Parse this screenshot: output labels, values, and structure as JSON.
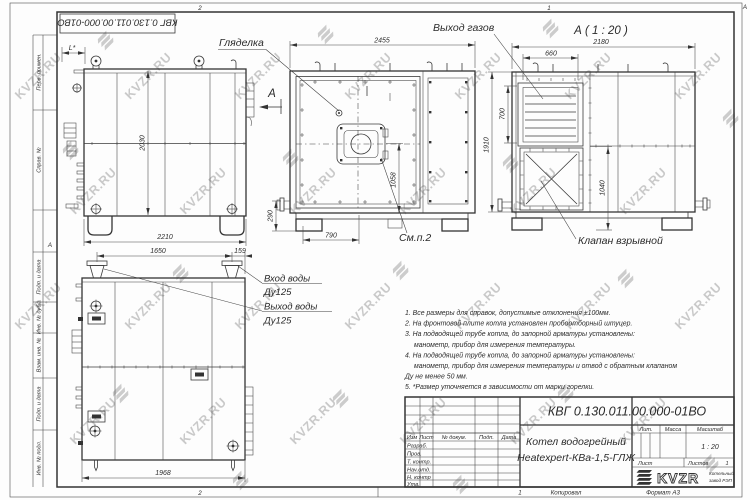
{
  "watermark": {
    "text": "KVZR.RU"
  },
  "frame": {
    "stamp": "КВГ 0.130.011.00.000-01ВО",
    "fold_top_left": "2",
    "fold_top_right": "1",
    "fold_bottom_left": "2",
    "fold_left_letter": "А",
    "fold_right_letter": "А",
    "margin_labels": {
      "perv": "Перв. примен.",
      "sprav": "Справ. №",
      "podp1": "Подп. и дата",
      "inv_dubl": "Инв. № дубл.",
      "vzam": "Взам. инв. №",
      "podp2": "Подп. и дата",
      "inv_podl": "Инв. № подл."
    }
  },
  "views": {
    "side": {
      "dim_l": "L*",
      "dim_height": "2030",
      "dim_width": "2210",
      "arrow_label": "А"
    },
    "front": {
      "sight_label": "Гляделка",
      "dim_width": "2455",
      "dim_burner": "1058",
      "dim_bottom": "790",
      "dim_stub": "290",
      "see_label": "См.п.2"
    },
    "rear": {
      "view_title": "А ( 1 : 20 )",
      "gas_label": "Выход газов",
      "valve_label": "Клапан взрывной",
      "dim_width": "2180",
      "dim_louver_w": "660",
      "dim_louver_h": "700",
      "dim_valve": "1040",
      "dim_height": "1910"
    },
    "top": {
      "inlet_label": "Вход воды",
      "inlet_dn": "Ду125",
      "outlet_label": "Выход воды",
      "outlet_dn": "Ду125",
      "dim_pipes": "1650",
      "dim_edge": "159",
      "dim_width": "1968"
    }
  },
  "notes": {
    "line1": "1. Все размеры для справок, допустимые отклонения ±100мм.",
    "line2": "2. На фронтовой плите котла установлен пробоотборный штуцер.",
    "line3": "3. На подводящей трубе котла, до запорной арматуры установлены:",
    "line4": "манометр, прибор для измерения температуры.",
    "line5": "4. На подводящей трубе котла, до запорной арматуры установлены:",
    "line6": "манометр, прибор для измерения температуры и отвод с обратным клапаном",
    "line7": "Ду не менее 50 мм.",
    "line8": "5. *Размер уточняется в зависимости от марки горелки."
  },
  "titleblock": {
    "doc_number": "КВГ 0.130.011.00.000-01ВО",
    "name1": "Котел водогрейный",
    "name2": "Heatexpert-КВа-1,5-ГЛЖ",
    "col_izm": "Изм",
    "col_list": "Лист",
    "col_doc": "№ докум.",
    "col_podp": "Подп.",
    "col_data": "Дата",
    "row1": "Разраб.",
    "row2": "Пров.",
    "row3": "Т. контр.",
    "row4": "Нач.отд.",
    "row5": "Н. контр",
    "row6": "Утв.",
    "lit": "Лит.",
    "mass": "Масса",
    "scale_label": "Масштаб",
    "scale": "1 : 20",
    "sheet_label": "Лист",
    "sheets_label": "Листов",
    "sheets_value": "1",
    "logo": "KVZR",
    "logo_sub1": "Котельный",
    "logo_sub2": "завод РЭП",
    "footer_num": "1",
    "footer_copy": "Копировал",
    "footer_format": "Формат А3"
  }
}
